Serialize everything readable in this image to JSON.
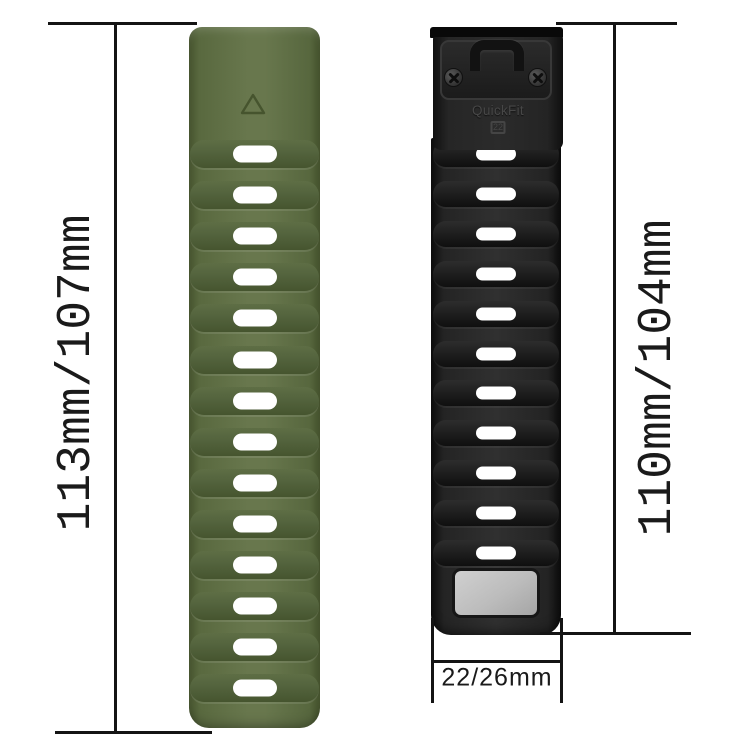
{
  "annotations": {
    "left_band_length": "113mm/107mm",
    "right_band_length": "110mm/104mm",
    "band_width": "22/26mm"
  },
  "connector": {
    "brand": "QuickFit",
    "size": "22"
  },
  "bands": {
    "left": {
      "color": "#5d6d45",
      "slot_count": 14
    },
    "right": {
      "color": "#232323",
      "slot_count": 11
    }
  }
}
